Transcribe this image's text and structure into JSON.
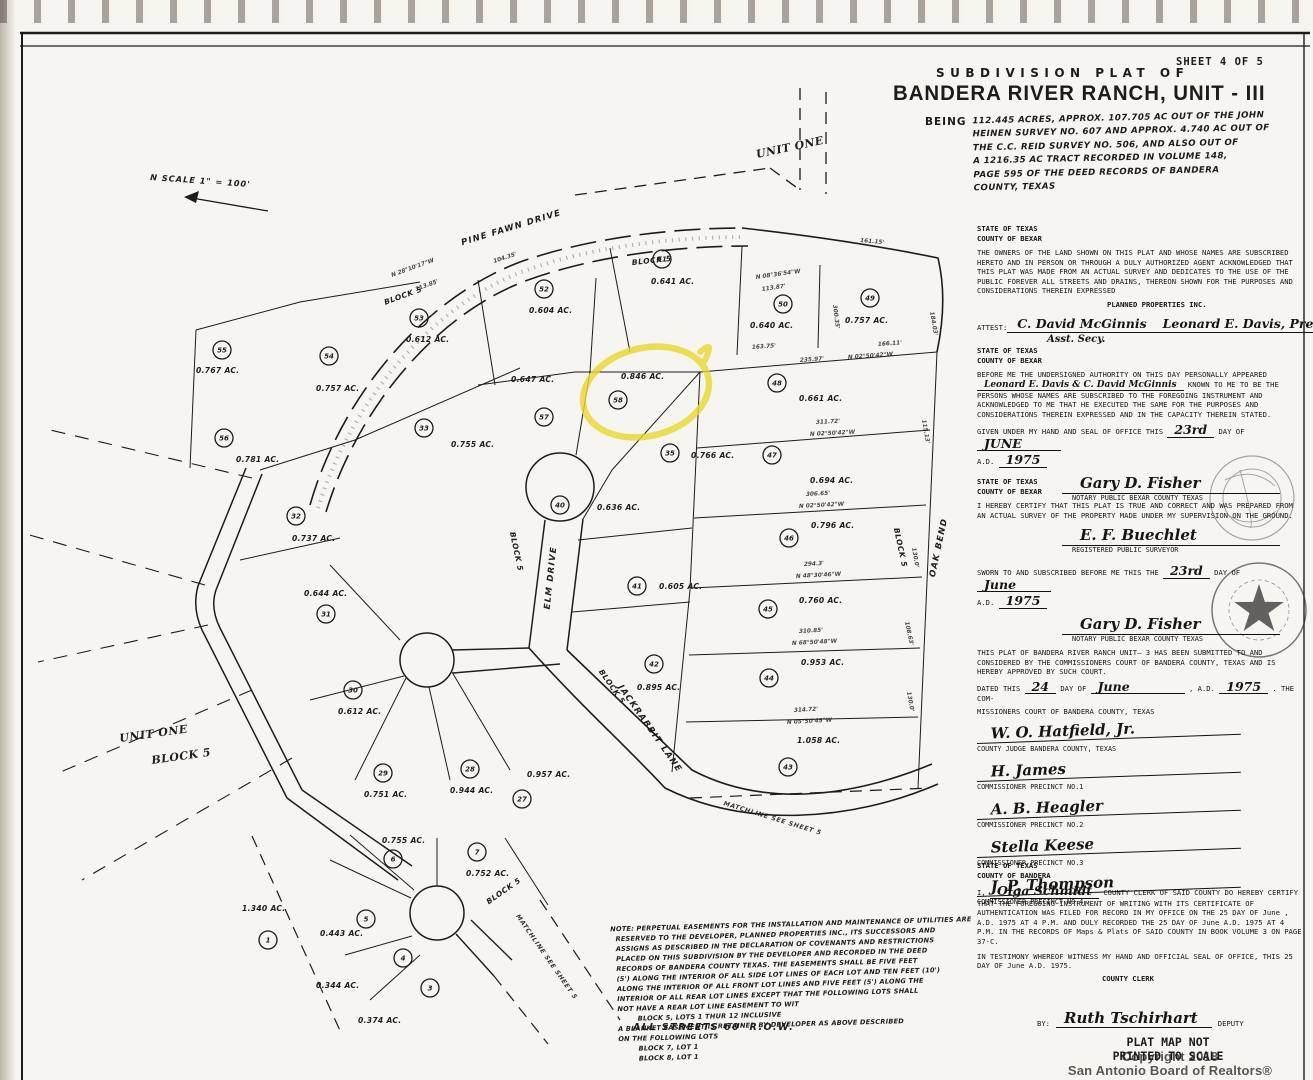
{
  "page": {
    "sheet_label": "SHEET 4 OF 5",
    "plat_of": "SUBDIVISION PLAT OF",
    "title": "BANDERA RIVER RANCH, UNIT - III",
    "being_label": "BEING",
    "description": "112.445 ACRES, APPROX. 107.705 AC OUT OF THE JOHN\nHEINEN SURVEY NO. 607 AND APPROX. 4.740 AC OUT OF\nTHE C.C. REID SURVEY NO. 506, AND ALSO OUT OF\nA 1216.35 AC TRACT RECORDED IN VOLUME 148,\nPAGE 595 OF THE DEED RECORDS OF BANDERA\nCOUNTY, TEXAS",
    "colors": {
      "highlight_yellow": "#e9d930",
      "ink": "#1d1d1d",
      "paper": "#f7f5ef"
    }
  },
  "map": {
    "north_label": "N   SCALE 1\" = 100'",
    "road_labels": [
      {
        "t": "PINE  FAWN  DRIVE",
        "x": 512,
        "y": 230,
        "r": -17
      },
      {
        "t": "ELM  DRIVE",
        "x": 553,
        "y": 578,
        "r": -84
      },
      {
        "t": "JACKRABBIT  LANE",
        "x": 648,
        "y": 730,
        "r": 55
      },
      {
        "t": "OAK  BEND",
        "x": 941,
        "y": 548,
        "r": -78
      }
    ],
    "block_labels": [
      {
        "t": "BLOCK 5",
        "x": 652,
        "y": 263,
        "r": -6
      },
      {
        "t": "BLOCK 5",
        "x": 404,
        "y": 298,
        "r": -20
      },
      {
        "t": "BLOCK 5",
        "x": 898,
        "y": 548,
        "r": 78
      },
      {
        "t": "BLOCK 5",
        "x": 514,
        "y": 552,
        "r": 78
      },
      {
        "t": "BLOCK 5",
        "x": 610,
        "y": 688,
        "r": 55
      },
      {
        "t": "BLOCK 5",
        "x": 505,
        "y": 893,
        "r": -35
      }
    ],
    "unit_labels": [
      {
        "t": "UNIT ONE",
        "x": 757,
        "y": 158,
        "r": -12
      },
      {
        "t": "UNIT ONE",
        "x": 120,
        "y": 742,
        "r": -8
      },
      {
        "t": "BLOCK 5",
        "x": 152,
        "y": 764,
        "r": -8
      }
    ],
    "matchline_labels": [
      {
        "t": "MATCHLINE  SEE  SHEET 5",
        "x": 772,
        "y": 820,
        "r": 17
      },
      {
        "t": "MATCHLINE  SEE  SHEET 5",
        "x": 545,
        "y": 958,
        "r": 55
      }
    ],
    "lots": [
      {
        "n": "55",
        "a": "0.767 AC.",
        "x": 222,
        "y": 350,
        "ax": 196,
        "ay": 373
      },
      {
        "n": "54",
        "a": "0.757 AC.",
        "x": 329,
        "y": 356,
        "ax": 316,
        "ay": 391
      },
      {
        "n": "53",
        "a": "0.612 AC.",
        "x": 419,
        "y": 318,
        "ax": 406,
        "ay": 342
      },
      {
        "n": "52",
        "a": "0.604 AC.",
        "x": 544,
        "y": 289,
        "ax": 529,
        "ay": 313
      },
      {
        "n": "51",
        "a": "0.641 AC.",
        "x": 662,
        "y": 259,
        "ax": 651,
        "ay": 284
      },
      {
        "n": "50",
        "a": "0.640 AC.",
        "x": 783,
        "y": 304,
        "ax": 750,
        "ay": 328
      },
      {
        "n": "49",
        "a": "0.757 AC.",
        "x": 870,
        "y": 298,
        "ax": 845,
        "ay": 323
      },
      {
        "n": "57",
        "a": "0.647 AC.",
        "x": 544,
        "y": 417,
        "ax": 511,
        "ay": 382
      },
      {
        "n": "58",
        "a": "0.846 AC.",
        "x": 618,
        "y": 400,
        "ax": 621,
        "ay": 379,
        "hl": true
      },
      {
        "n": "33",
        "a": "0.755 AC.",
        "x": 424,
        "y": 428,
        "ax": 451,
        "ay": 447
      },
      {
        "n": "35",
        "a": "0.766 AC.",
        "x": 670,
        "y": 453,
        "ax": 691,
        "ay": 458
      },
      {
        "n": "48",
        "a": "0.661 AC.",
        "x": 777,
        "y": 383,
        "ax": 799,
        "ay": 401
      },
      {
        "n": "47",
        "a": "0.694 AC.",
        "x": 772,
        "y": 455,
        "ax": 810,
        "ay": 483
      },
      {
        "n": "46",
        "a": "0.796 AC.",
        "x": 789,
        "y": 538,
        "ax": 811,
        "ay": 528
      },
      {
        "n": "45",
        "a": "0.760 AC.",
        "x": 768,
        "y": 609,
        "ax": 799,
        "ay": 603
      },
      {
        "n": "44",
        "a": "0.953 AC.",
        "x": 769,
        "y": 678,
        "ax": 801,
        "ay": 665
      },
      {
        "n": "43",
        "a": "1.058 AC.",
        "x": 788,
        "y": 767,
        "ax": 797,
        "ay": 743
      },
      {
        "n": "40",
        "a": "0.636 AC.",
        "x": 560,
        "y": 505,
        "ax": 597,
        "ay": 510
      },
      {
        "n": "41",
        "a": "0.605 AC.",
        "x": 637,
        "y": 586,
        "ax": 659,
        "ay": 589
      },
      {
        "n": "42",
        "a": "0.895 AC.",
        "x": 654,
        "y": 664,
        "ax": 637,
        "ay": 690
      },
      {
        "n": "56",
        "a": "0.781 AC.",
        "x": 224,
        "y": 438,
        "ax": 236,
        "ay": 462
      },
      {
        "n": "32",
        "a": "0.737 AC.",
        "x": 296,
        "y": 516,
        "ax": 292,
        "ay": 541
      },
      {
        "n": "31",
        "a": "0.644 AC.",
        "x": 326,
        "y": 614,
        "ax": 304,
        "ay": 596
      },
      {
        "n": "30",
        "a": "0.612 AC.",
        "x": 353,
        "y": 690,
        "ax": 338,
        "ay": 714
      },
      {
        "n": "29",
        "a": "0.751 AC.",
        "x": 383,
        "y": 773,
        "ax": 364,
        "ay": 797
      },
      {
        "n": "28",
        "a": "0.944 AC.",
        "x": 470,
        "y": 769,
        "ax": 450,
        "ay": 793
      },
      {
        "n": "27",
        "a": "0.957 AC.",
        "x": 522,
        "y": 799,
        "ax": 527,
        "ay": 777
      },
      {
        "n": "6",
        "a": "0.755 AC.",
        "x": 393,
        "y": 859,
        "ax": 382,
        "ay": 843
      },
      {
        "n": "7",
        "a": "0.752 AC.",
        "x": 477,
        "y": 852,
        "ax": 466,
        "ay": 876
      },
      {
        "n": "5",
        "a": "0.443 AC.",
        "x": 366,
        "y": 919,
        "ax": 320,
        "ay": 936
      },
      {
        "n": "4",
        "a": "0.344 AC.",
        "x": 403,
        "y": 958,
        "ax": 316,
        "ay": 988
      },
      {
        "n": "3",
        "a": "0.374 AC.",
        "x": 430,
        "y": 988,
        "ax": 358,
        "ay": 1023
      },
      {
        "n": "1",
        "a": "1.340 AC.",
        "x": 268,
        "y": 940,
        "ax": 242,
        "ay": 911
      }
    ],
    "dimensions": [
      {
        "t": "N 08°36'54\"W",
        "x": 756,
        "y": 279,
        "r": -8
      },
      {
        "t": "113.87'",
        "x": 762,
        "y": 291,
        "r": -8
      },
      {
        "t": "161.15'",
        "x": 860,
        "y": 242,
        "r": 5
      },
      {
        "t": "300.35'",
        "x": 833,
        "y": 305,
        "r": 83
      },
      {
        "t": "184.03'",
        "x": 930,
        "y": 312,
        "r": 80
      },
      {
        "t": "163.75'",
        "x": 752,
        "y": 349,
        "r": -4
      },
      {
        "t": "235.97'",
        "x": 800,
        "y": 362,
        "r": -4
      },
      {
        "t": "N 02°50'42\"W",
        "x": 848,
        "y": 359,
        "r": -4
      },
      {
        "t": "166.11'",
        "x": 878,
        "y": 346,
        "r": -4
      },
      {
        "t": "311.72'",
        "x": 816,
        "y": 424,
        "r": -3
      },
      {
        "t": "N 02°50'42\"W",
        "x": 810,
        "y": 436,
        "r": -3
      },
      {
        "t": "306.65'",
        "x": 806,
        "y": 496,
        "r": -3
      },
      {
        "t": "N 02°50'42\"W",
        "x": 799,
        "y": 508,
        "r": -3
      },
      {
        "t": "294.3'",
        "x": 804,
        "y": 566,
        "r": -3
      },
      {
        "t": "N 48°30'46\"W",
        "x": 796,
        "y": 578,
        "r": -3
      },
      {
        "t": "310.85'",
        "x": 799,
        "y": 633,
        "r": -3
      },
      {
        "t": "N 68°50'48\"W",
        "x": 792,
        "y": 645,
        "r": -3
      },
      {
        "t": "314.72'",
        "x": 794,
        "y": 712,
        "r": -3
      },
      {
        "t": "N 05°50'45\"W",
        "x": 787,
        "y": 724,
        "r": -3
      },
      {
        "t": "115.13'",
        "x": 922,
        "y": 420,
        "r": 80
      },
      {
        "t": "130.0'",
        "x": 912,
        "y": 548,
        "r": 80
      },
      {
        "t": "108.63'",
        "x": 905,
        "y": 622,
        "r": 78
      },
      {
        "t": "130.0'",
        "x": 907,
        "y": 692,
        "r": 80
      },
      {
        "t": "N 28°10'17\"W",
        "x": 392,
        "y": 277,
        "r": -20
      },
      {
        "t": "113.85'",
        "x": 416,
        "y": 291,
        "r": -20
      },
      {
        "t": "104.35'",
        "x": 494,
        "y": 263,
        "r": -18
      }
    ]
  },
  "legal": {
    "owners": {
      "heading": "STATE OF TEXAS\nCOUNTY OF BEXAR",
      "body": "THE OWNERS OF THE LAND SHOWN ON THIS PLAT AND WHOSE NAMES ARE SUBSCRIBED HERETO AND IN PERSON OR THROUGH A DULY AUTHORIZED AGENT ACKNOWLEDGED THAT THIS PLAT WAS MADE FROM AN ACTUAL SURVEY AND DEDICATES TO THE USE OF THE PUBLIC FOREVER ALL STREETS AND DRAINS, THEREON SHOWN FOR THE PURPOSES AND CONSIDERATIONS THEREIN EXPRESSED",
      "company": "PLANNED PROPERTIES INC.",
      "attest_label": "ATTEST:",
      "attest_sig": "C. David McGinnis",
      "attest_sub": "Asst. Secy.",
      "pres_sig": "Leonard E. Davis, Pres."
    },
    "notary1": {
      "heading": "STATE OF TEXAS\nCOUNTY OF BEXAR",
      "body_1": "BEFORE ME THE UNDERSIGNED AUTHORITY ON THIS DAY PERSONALLY APPEARED",
      "names": "Leonard E. Davis & C. David McGinnis",
      "body_2": "KNOWN TO ME TO BE THE PERSONS WHOSE NAMES ARE SUBSCRIBED TO THE FOREGOING INSTRUMENT AND ACKNOWLEDGED TO ME THAT HE EXECUTED THE SAME FOR THE PURPOSES AND CONSIDERATIONS THEREIN EXPRESSED AND IN THE CAPACITY THEREIN STATED.",
      "given": "GIVEN UNDER MY HAND AND SEAL OF OFFICE THIS",
      "day": "23rd",
      "day_of": "DAY OF",
      "month": "JUNE",
      "ad": "A.D.",
      "year": "1975",
      "sig": "Gary D. Fisher",
      "sig_label": "NOTARY PUBLIC BEXAR COUNTY TEXAS"
    },
    "surveyor": {
      "heading": "STATE OF TEXAS\nCOUNTY OF BEXAR",
      "body": "I HEREBY CERTIFY THAT THIS PLAT IS TRUE AND CORRECT AND WAS PREPARED FROM AN ACTUAL SURVEY OF THE PROPERTY MADE UNDER MY SUPERVISION ON THE GROUND.",
      "sig": "E. F. Buechlet",
      "sig_label": "REGISTERED PUBLIC SURVEYOR",
      "sworn_1": "SWORN TO AND SUBSCRIBED BEFORE ME THIS THE",
      "sworn_day": "23rd",
      "sworn_2": "DAY OF",
      "sworn_month": "June",
      "ad": "A.D.",
      "year": "1975",
      "sig2": "Gary D. Fisher",
      "sig2_label": "NOTARY PUBLIC   BEXAR COUNTY TEXAS"
    },
    "court": {
      "body": "THIS PLAT OF BANDERA RIVER RANCH UNIT— 3 HAS BEEN SUBMITTED TO AND CONSIDERED BY THE COMMISSIONERS COURT OF BANDERA COUNTY, TEXAS AND IS HEREBY APPROVED BY SUCH COURT.",
      "dated_1": "DATED THIS",
      "dated_day": "24",
      "dated_2": "DAY OF",
      "dated_month": "June",
      "dated_3": ", A.D.",
      "dated_year": "1975",
      "dated_4": ". THE COM-",
      "dated_5": "MISSIONERS COURT OF BANDERA COUNTY, TEXAS",
      "signers": [
        {
          "sig": "W. O. Hatfield, Jr.",
          "label": "COUNTY JUDGE BANDERA COUNTY, TEXAS"
        },
        {
          "sig": "H. James",
          "label": "COMMISSIONER PRECINCT NO.1"
        },
        {
          "sig": "A. B. Heagler",
          "label": "COMMISSIONER PRECINCT NO.2"
        },
        {
          "sig": "Stella Keese",
          "label": "COMMISSIONER PRECINCT NO.3"
        },
        {
          "sig": "J. P. Thompson",
          "label": "COMMISSIONER PRECINCT NO.4"
        }
      ]
    },
    "clerk": {
      "heading": "STATE OF TEXAS\nCOUNTY OF BANDERA",
      "i_label": "I,",
      "name": "Olga Schmidt",
      "body": "COUNTY CLERK OF SAID COUNTY DO HEREBY CERTIFY THAT THE FOREGOING INSTRUMENT OF WRITING WITH ITS CERTIFICATE OF AUTHENTICATION WAS FILED FOR RECORD IN MY OFFICE ON THE 25 DAY OF June , A.D. 1975 AT 4 P.M. AND DULY RECORDED THE 25 DAY OF June A.D. 1975 AT 4 P.M. IN THE RECORDS OF Maps & Plats OF SAID COUNTY IN BOOK VOLUME 3 ON PAGE 37-C.",
      "testimony": "IN TESTIMONY WHEREOF WITNESS MY HAND AND OFFICIAL SEAL OF OFFICE, THIS 25 DAY OF June A.D. 1975.",
      "clerk_label": "COUNTY CLERK",
      "by_label": "BY:",
      "deputy_sig": "Ruth Tschirhart",
      "deputy_label": "DEPUTY"
    }
  },
  "notes": {
    "lines": [
      "NOTE: PERPETUAL EASEMENTS FOR THE INSTALLATION AND MAINTENANCE OF UTILITIES ARE",
      "  RESERVED TO THE DEVELOPER, PLANNED PROPERTIES INC., ITS SUCCESSORS AND",
      "  ASSIGNS AS DESCRIBED IN THE DECLARATION OF COVENANTS AND RESTRICTIONS",
      "  PLACED ON THIS SUBDIVISION BY THE DEVELOPER AND RECORDED IN THE DEED",
      "  RECORDS OF BANDERA COUNTY TEXAS. THE EASEMENTS SHALL BE FIVE FEET",
      "  (5') ALONG THE INTERIOR OF ALL SIDE LOT LINES OF EACH LOT AND TEN FEET (10')",
      "  ALONG THE INTERIOR OF ALL FRONT LOT LINES AND FIVE FEET (5') ALONG THE",
      "  INTERIOR OF ALL REAR LOT LINES EXCEPT THAT THE FOLLOWING LOTS SHALL",
      "  NOT HAVE A REAR LOT LINE EASEMENT TO WIT",
      "          BLOCK 5, LOTS 1 THUR 12 INCLUSIVE",
      "  A BLANKET EASEMENT IS RETAINED BY DEVELOPER AS ABOVE DESCRIBED",
      "  ON THE FOLLOWING LOTS",
      "          BLOCK 7, LOT 1",
      "          BLOCK 8, LOT 1"
    ],
    "streets": "ALL STREETS 60' R.O.W."
  },
  "footer": {
    "not_to_scale": "PLAT MAP NOT\nPRINTED TO SCALE",
    "copyright": "Copyright 2018\nSan Antonio Board of Realtors®"
  }
}
